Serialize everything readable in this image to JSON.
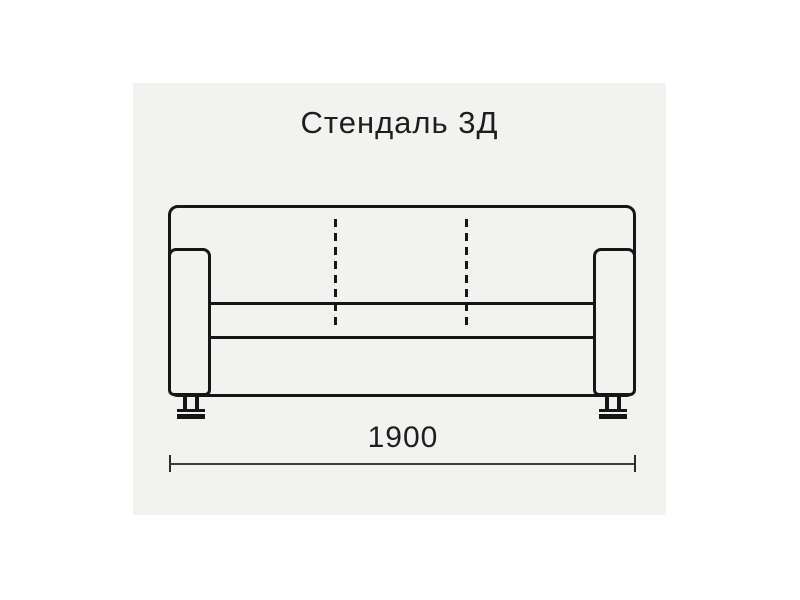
{
  "title": "Стендаль 3Д",
  "dimension": {
    "value": "1900"
  },
  "colors": {
    "page_background": "#ffffff",
    "panel_background": "#f2f3f1",
    "outline": "#161616",
    "dimension_line": "#3c3c3c",
    "text": "#1e1e1e"
  }
}
